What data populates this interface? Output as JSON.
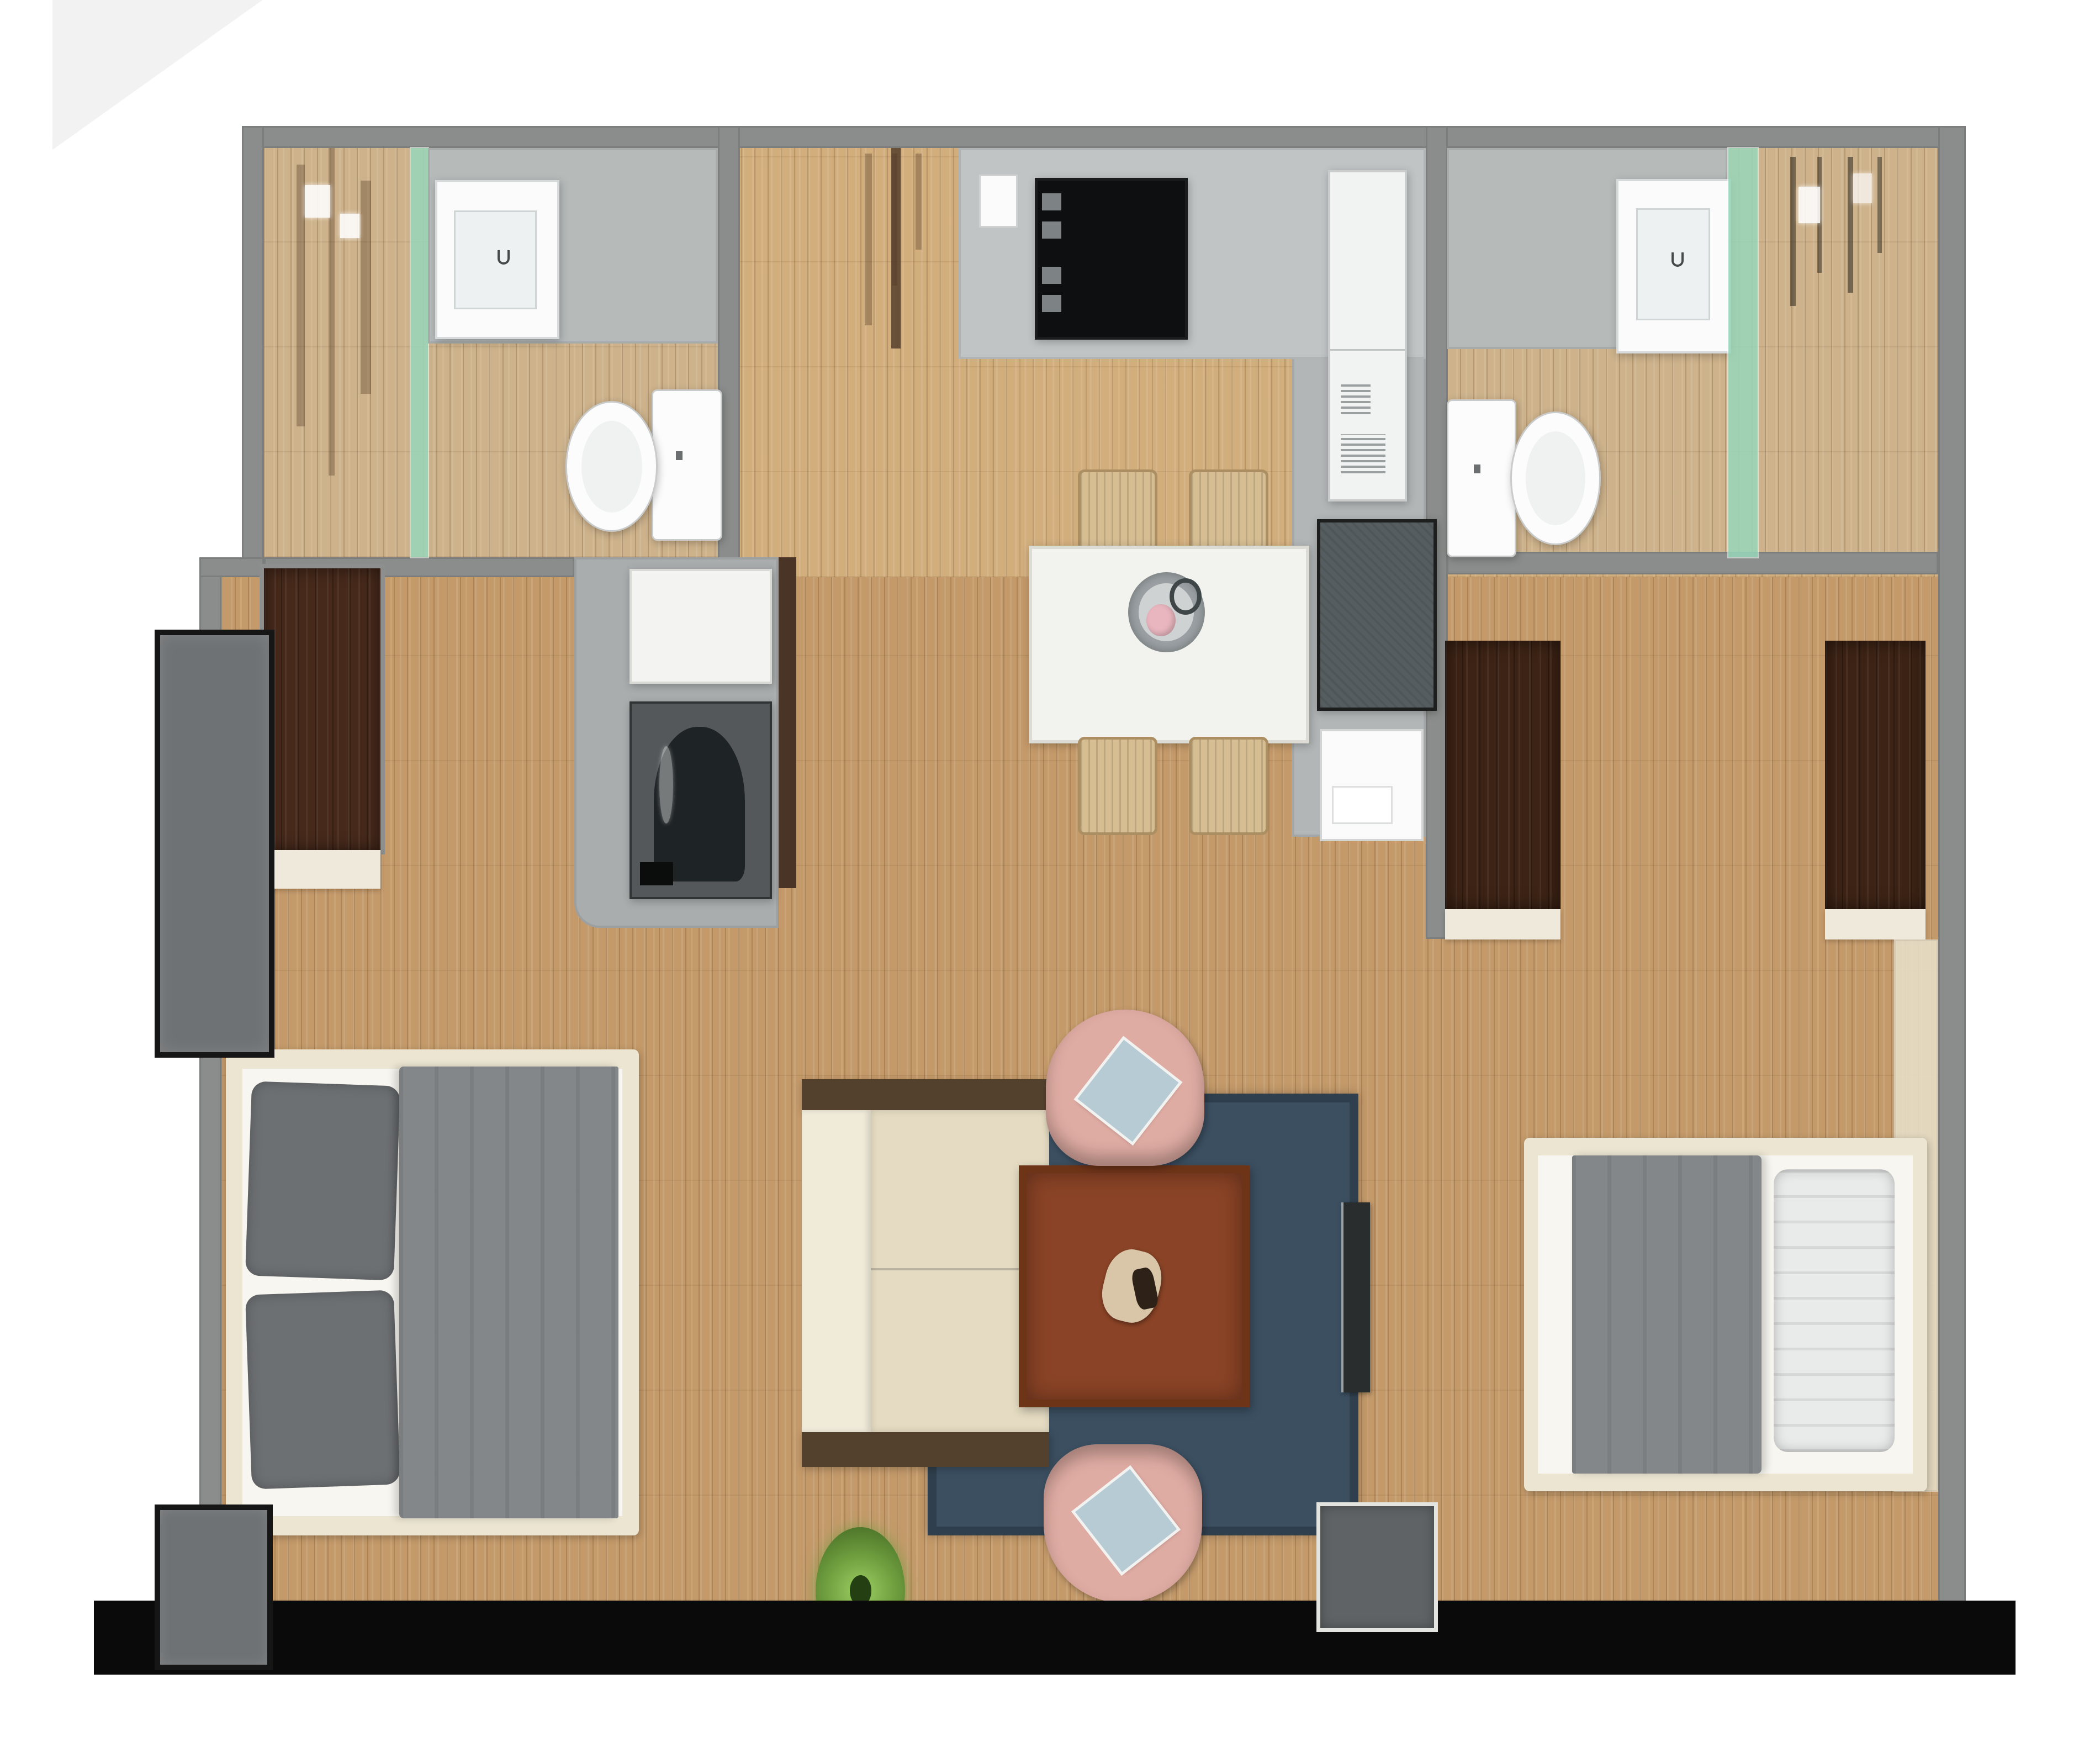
{
  "colors": {
    "page_bg": "#ffffff",
    "corner_shadow": "#e7e7e7",
    "black_bar": "#0a0a0a",
    "wall": "#8b8d8c",
    "floor_main": "#c49a6a",
    "floor_bath": "#cdb28b",
    "floor_corridor": "#d2ae7d",
    "glass_green": "rgba(150,214,184,0.85)",
    "counter_gray": "#c0c4c4",
    "bath_counter": "#b6bbba",
    "core_gray": "#b2b6b7",
    "cooktop_black": "#0e0f10",
    "knob_gray": "#7d8284",
    "fridge_white": "#f1f2f2",
    "island_gray": "#565d60",
    "island_border": "#1d1e1e",
    "sink_white": "#fafbfa",
    "basin_gray": "#eef1f1",
    "toilet_white": "#fcfcfc",
    "laundry_box": "#a9adae",
    "washer_dark": "#54585a",
    "washer_drum": "#1e2325",
    "washer_top": "#f3f3f1",
    "jamb_brown": "#4a3425",
    "door_brown": "#46291b",
    "wardrobe_brown": "#3d2315",
    "shelf_cream": "#efe9dc",
    "window_gray": "#6f7274",
    "window_frame": "#161616",
    "patio_gray": "#5f6365",
    "rug_blue": "#3b4f61",
    "sofa_back": "#f0ead9",
    "sofa_seat": "#e5dbc2",
    "sofa_wood": "#53412e",
    "coffee_table": "#8a4326",
    "coffee_frame": "#6e3418",
    "ornament_beige": "#d9c6a8",
    "armchair_pink": "#dfaca3",
    "armchair_cushion": "#b7cbd4",
    "plant_green": "#6f9e3f",
    "dining_white": "#f2f3ef",
    "chair_tan": "#d6bd92",
    "chair_frame": "#ab8f63",
    "bowl_gray": "#9aa0a3",
    "bowl_inner": "#cfd2d3",
    "bowl_pink": "#e9b6bf",
    "bed_frame_cream": "#ece5d2",
    "bed_sheet": "#f8f6f0",
    "duvet_gray": "#83878a",
    "pillow_gray": "#6d7073",
    "pillow_white": "#e9eaea",
    "side_panel_cream": "#e7dec8",
    "tv_dark": "#2a2d2e"
  },
  "items": {
    "rooms": [
      "bathroom-left",
      "bathroom-right",
      "kitchen",
      "dining-area",
      "living-room",
      "bedroom-left",
      "bedroom-right",
      "laundry-closet"
    ],
    "fixtures": [
      "shower",
      "vanity-sink",
      "toilet",
      "cooktop",
      "fridge",
      "kitchen-island",
      "island-sink",
      "washing-machine",
      "dining-table",
      "dining-chair",
      "centerpiece-bowl",
      "sofa",
      "coffee-table",
      "armchair",
      "area-rug",
      "potted-plant",
      "tv-console",
      "double-bed",
      "wardrobe",
      "sliding-closet",
      "window-panel",
      "patio-door"
    ]
  }
}
